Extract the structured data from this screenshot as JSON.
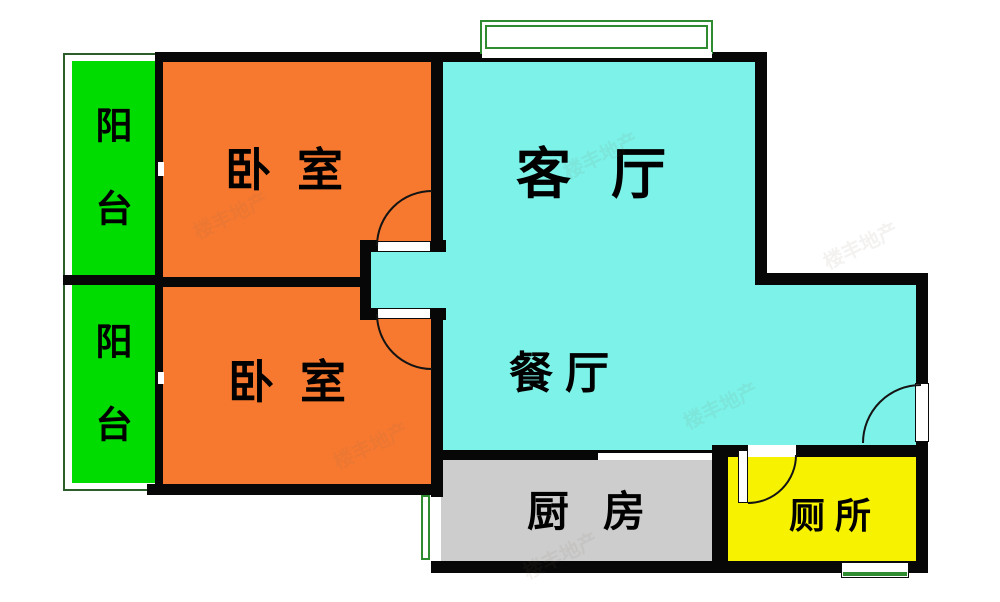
{
  "plan": {
    "rooms": [
      {
        "key": "balcony-north",
        "label": "阳台",
        "fill": "#00dc00"
      },
      {
        "key": "balcony-south",
        "label": "阳台",
        "fill": "#00dc00"
      },
      {
        "key": "bedroom-north",
        "label": "卧室",
        "fill": "#f7792f"
      },
      {
        "key": "bedroom-south",
        "label": "卧室",
        "fill": "#f7792f"
      },
      {
        "key": "living-room",
        "label": "客厅",
        "fill": "#7df2e8"
      },
      {
        "key": "dining-room",
        "label": "餐厅",
        "fill": "#7df2e8"
      },
      {
        "key": "kitchen",
        "label": "厨房",
        "fill": "#cdcdcd"
      },
      {
        "key": "toilet",
        "label": "厕所",
        "fill": "#f6f200"
      }
    ],
    "colors": {
      "wall": "#070707",
      "window_green": "#2f8b2f",
      "balcony_outline": "#2c5e2c",
      "background": "#ffffff"
    },
    "watermark": "楼丰地产"
  }
}
